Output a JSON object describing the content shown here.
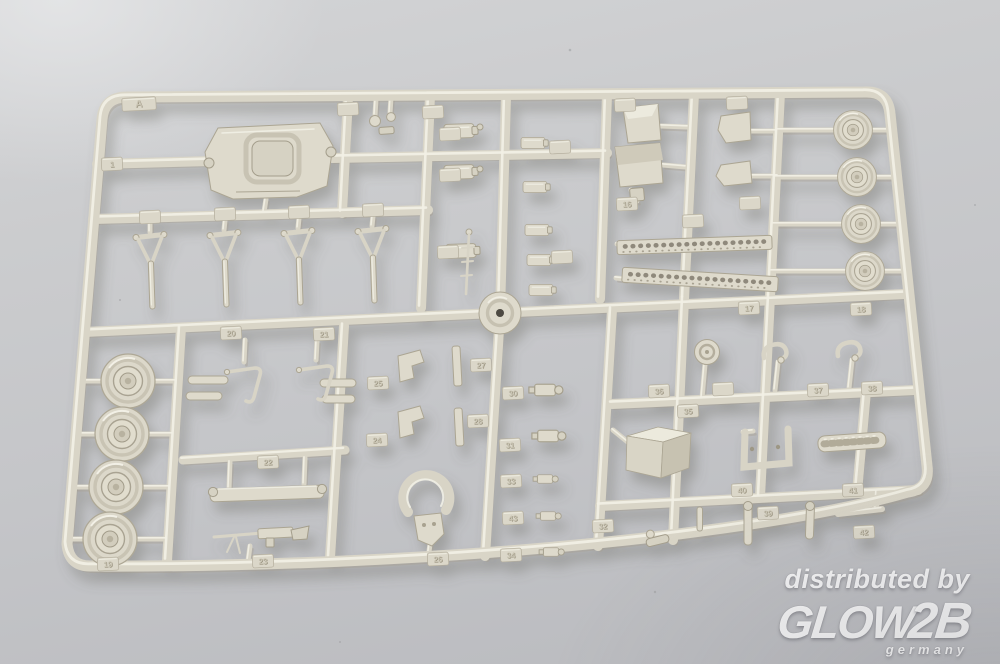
{
  "watermark": {
    "tagline": "distributed by",
    "brand": "GLOW",
    "brand_suffix": "2B",
    "country": "germany"
  },
  "colors": {
    "plastic": "#d9d5c7",
    "plastic_hi": "#f1efe5",
    "plastic_sh": "#a29c8b",
    "part_fill": "#dedacc",
    "part_stroke": "#aba593",
    "tag_fill": "#dbd7c9",
    "bg_top": "#d2d3d5",
    "bg_bottom": "#b7b8bc"
  },
  "sprue": {
    "letter": "A",
    "part_tags": [
      {
        "label": "A",
        "x": 139,
        "y": 104,
        "w": 34
      },
      {
        "label": "",
        "x": 348,
        "y": 109
      },
      {
        "label": "",
        "x": 433,
        "y": 112
      },
      {
        "label": "1",
        "x": 112,
        "y": 164
      },
      {
        "label": "",
        "x": 625,
        "y": 105
      },
      {
        "label": "",
        "x": 737,
        "y": 103
      },
      {
        "label": "",
        "x": 150,
        "y": 217
      },
      {
        "label": "",
        "x": 225,
        "y": 214
      },
      {
        "label": "",
        "x": 299,
        "y": 212
      },
      {
        "label": "",
        "x": 373,
        "y": 210
      },
      {
        "label": "",
        "x": 450,
        "y": 134
      },
      {
        "label": "",
        "x": 450,
        "y": 175
      },
      {
        "label": "",
        "x": 448,
        "y": 252
      },
      {
        "label": "",
        "x": 560,
        "y": 147
      },
      {
        "label": "",
        "x": 562,
        "y": 257
      },
      {
        "label": "16",
        "x": 627,
        "y": 204
      },
      {
        "label": "",
        "x": 750,
        "y": 203
      },
      {
        "label": "",
        "x": 693,
        "y": 221
      },
      {
        "label": "17",
        "x": 749,
        "y": 308
      },
      {
        "label": "18",
        "x": 861,
        "y": 309
      },
      {
        "label": "20",
        "x": 231,
        "y": 333
      },
      {
        "label": "21",
        "x": 324,
        "y": 334
      },
      {
        "label": "22",
        "x": 268,
        "y": 462
      },
      {
        "label": "19",
        "x": 108,
        "y": 564
      },
      {
        "label": "23",
        "x": 263,
        "y": 561
      },
      {
        "label": "25",
        "x": 378,
        "y": 383
      },
      {
        "label": "27",
        "x": 481,
        "y": 365
      },
      {
        "label": "24",
        "x": 377,
        "y": 440
      },
      {
        "label": "28",
        "x": 478,
        "y": 421
      },
      {
        "label": "26",
        "x": 438,
        "y": 559
      },
      {
        "label": "30",
        "x": 513,
        "y": 393
      },
      {
        "label": "31",
        "x": 510,
        "y": 445
      },
      {
        "label": "33",
        "x": 511,
        "y": 481
      },
      {
        "label": "43",
        "x": 513,
        "y": 518
      },
      {
        "label": "34",
        "x": 511,
        "y": 555
      },
      {
        "label": "32",
        "x": 603,
        "y": 526
      },
      {
        "label": "36",
        "x": 659,
        "y": 391
      },
      {
        "label": "",
        "x": 723,
        "y": 389
      },
      {
        "label": "35",
        "x": 688,
        "y": 411
      },
      {
        "label": "37",
        "x": 818,
        "y": 390
      },
      {
        "label": "38",
        "x": 872,
        "y": 388
      },
      {
        "label": "40",
        "x": 742,
        "y": 490
      },
      {
        "label": "41",
        "x": 853,
        "y": 490
      },
      {
        "label": "39",
        "x": 768,
        "y": 513
      },
      {
        "label": "42",
        "x": 864,
        "y": 532
      }
    ]
  }
}
